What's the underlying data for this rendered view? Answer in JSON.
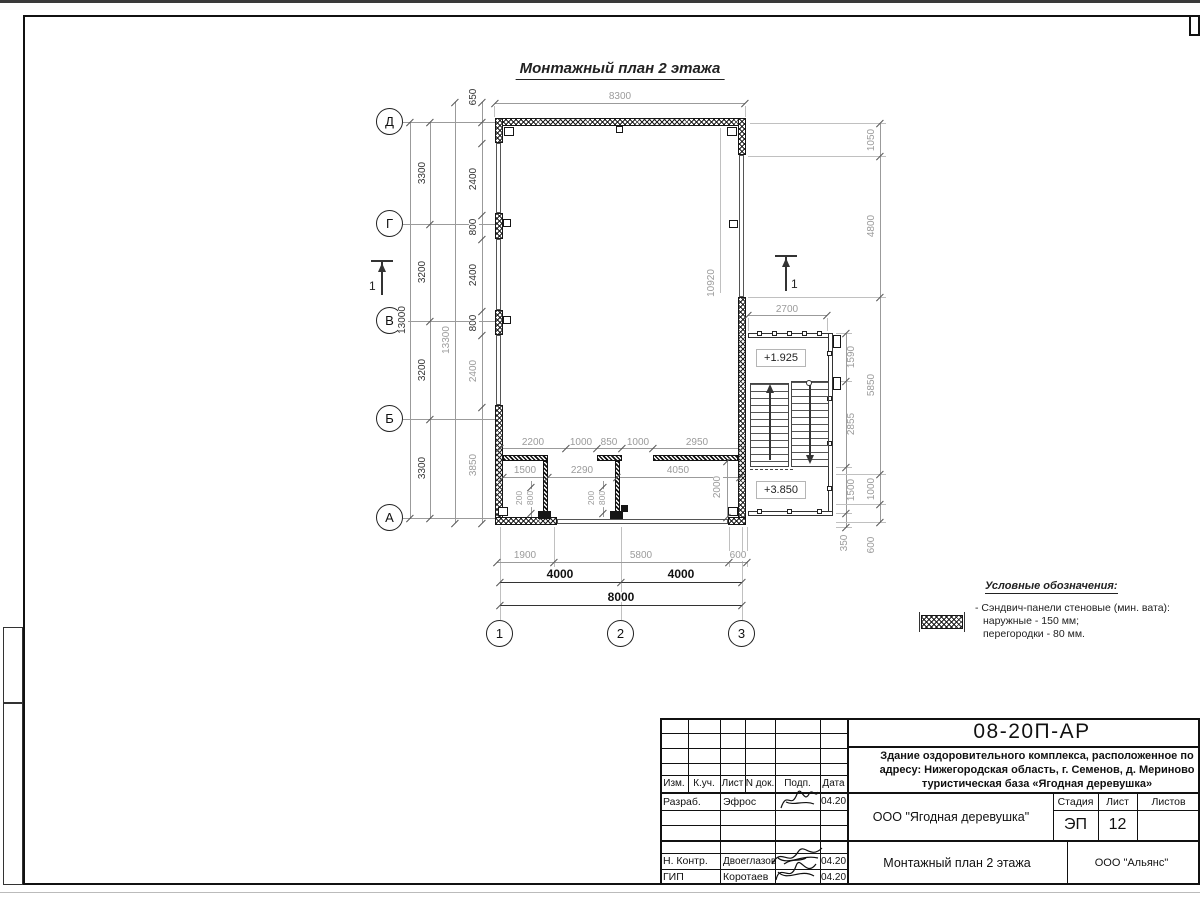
{
  "title": "Монтажный план 2 этажа",
  "axes": {
    "horizontal": [
      "Д",
      "Г",
      "В",
      "Б",
      "А"
    ],
    "vertical": [
      "1",
      "2",
      "3"
    ]
  },
  "section_label": "1",
  "levels": {
    "upper_landing": "+1.925",
    "floor": "+3.850"
  },
  "dims": {
    "top_width": "8300",
    "left_total": "13000",
    "left_overall": "13300",
    "left_axis": [
      "3300",
      "3200",
      "3200",
      "3300"
    ],
    "left_facade": [
      "650",
      "2400",
      "800",
      "2400",
      "800",
      "2400",
      "3850"
    ],
    "hall_depth": "10920",
    "stair_width": "2700",
    "right_facade": [
      "1050",
      "4800",
      "5850",
      "1000",
      "600"
    ],
    "stair_chain": [
      "1590",
      "2855",
      "1500",
      "350"
    ],
    "partition_chain": [
      "2200",
      "1000",
      "850",
      "1000",
      "2950"
    ],
    "room_chain": [
      "1500",
      "2290",
      "4050"
    ],
    "door_left": [
      "200",
      "800"
    ],
    "door_right": [
      "200",
      "800"
    ],
    "room_depth": "2000",
    "bottom_chain": [
      "1900",
      "5800",
      "600"
    ],
    "axis_spans": [
      "4000",
      "4000"
    ],
    "bottom_total": "8000"
  },
  "legend": {
    "title": "Условные обозначения:",
    "symbol": "sandwich-panel-crosshatch",
    "item_line1": "- Сэндвич-панели стеновые (мин. вата):",
    "item_line2": "наружные - 150 мм;",
    "item_line3": "перегородки - 80 мм."
  },
  "titleblock": {
    "doc_number": "08-20П-АР",
    "project_line1": "Здание оздоровительного комплекса, расположенное по",
    "project_line2": "адресу: Нижегородская область, г. Семенов, д. Мериново",
    "project_line3": "туристическая база «Ягодная деревушка»",
    "cols": [
      "Изм.",
      "К.уч.",
      "Лист",
      "N док.",
      "Подп.",
      "Дата"
    ],
    "rows": [
      {
        "role": "Разраб.",
        "name": "Эфрос",
        "date": "04.20"
      },
      {
        "role": "Н. Контр.",
        "name": "Двоеглазов",
        "date": "04.20"
      },
      {
        "role": "ГИП",
        "name": "Коротаев",
        "date": "04.20"
      }
    ],
    "client": "ООО \"Ягодная деревушка\"",
    "stage_label": "Стадия",
    "sheet_label": "Лист",
    "sheets_label": "Листов",
    "stage": "ЭП",
    "sheet_num": "12",
    "drawing_name": "Монтажный план 2 этажа",
    "org": "ООО \"Альянс\""
  }
}
